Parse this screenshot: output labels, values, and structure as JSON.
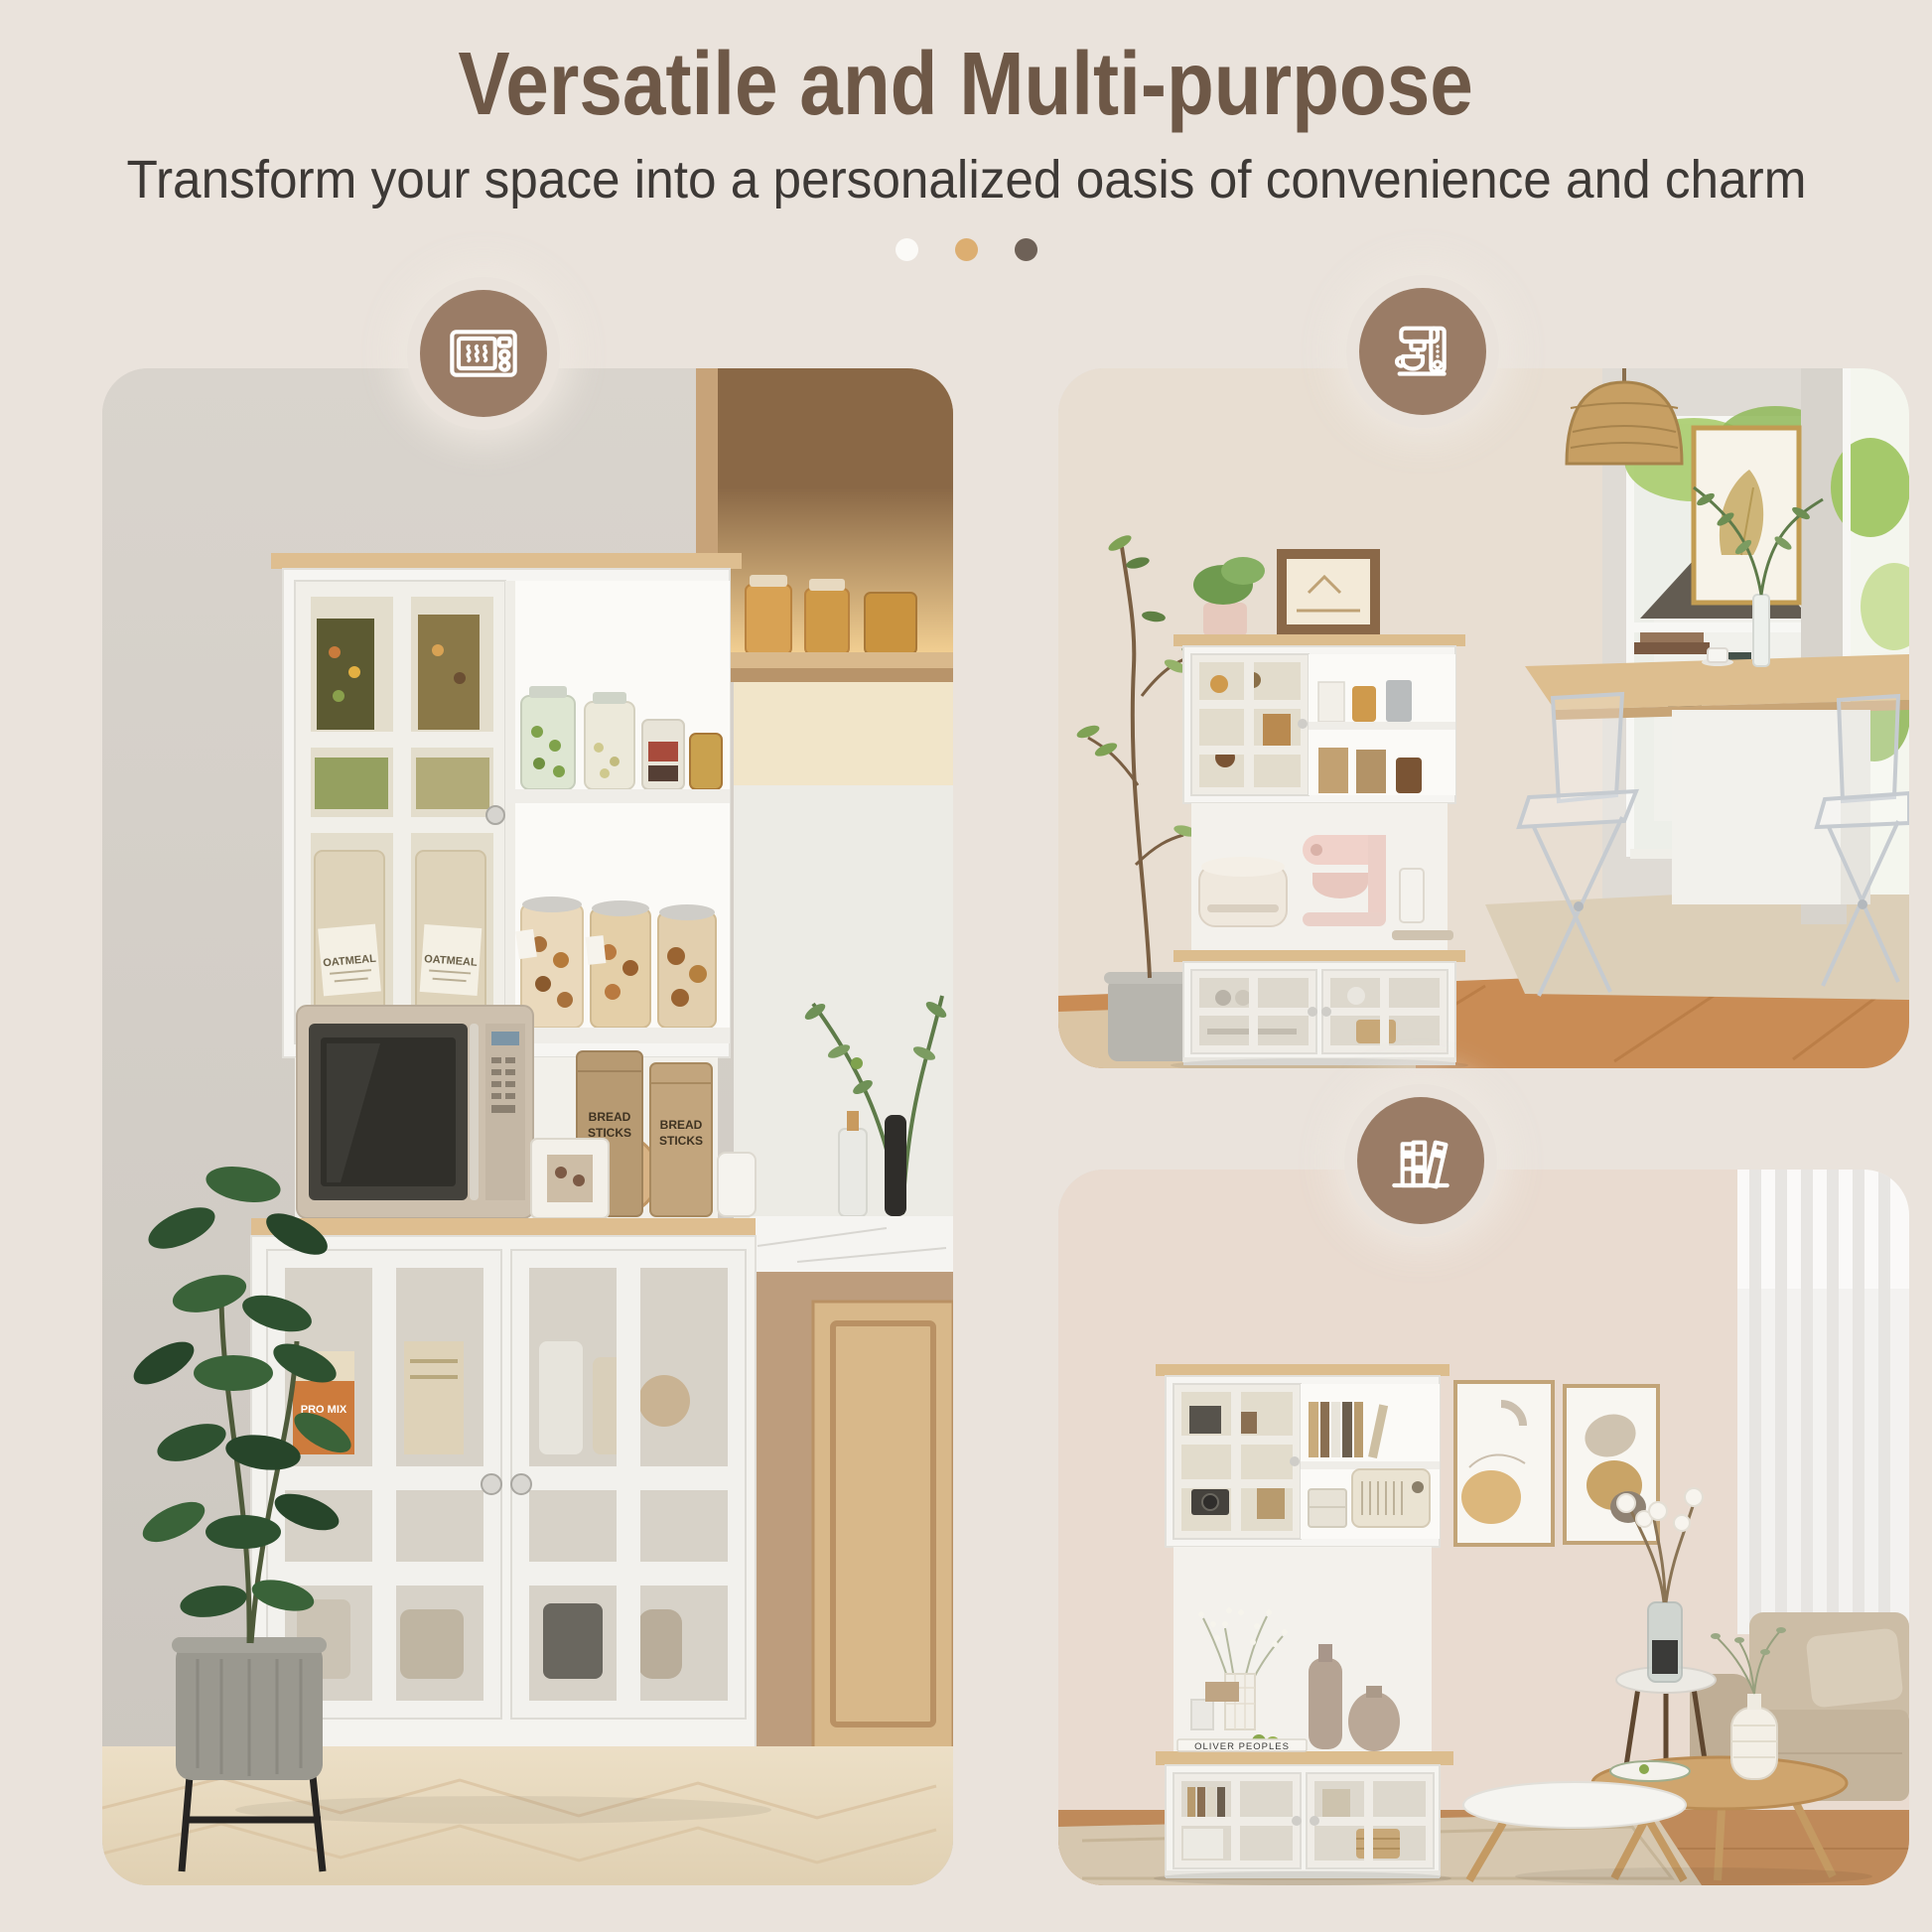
{
  "header": {
    "title": "Versatile and Multi-purpose",
    "subtitle": "Transform your space into a personalized oasis of convenience and charm"
  },
  "carousel_dots": [
    "#fbfaf7",
    "#dcae71",
    "#6e6157"
  ],
  "colors": {
    "background": "#eae3dc",
    "title_brown": "#6e5847",
    "subtitle_gray": "#3d3936",
    "badge_brown": "#9a7c66",
    "badge_icon": "#ffffff",
    "oak_top": "#dcbd8e",
    "cabinet_white": "#f6f5f2"
  },
  "badges": [
    {
      "icon": "microwave-icon"
    },
    {
      "icon": "coffee-machine-icon"
    },
    {
      "icon": "books-icon"
    }
  ],
  "photos": {
    "kitchen_pantry": {
      "description": "Kitchen nook: white buffet hutch with oak top, glass-pane upper cabinet and open shelves full of snack jars, a microwave and bread-stick bags on the counter, two glass doors below, flanked by oak open shelving, a marble-top oak cabinet and a fiddle-leaf fig plant on light herringbone wood flooring",
      "labels": {
        "bread": "BREAD",
        "sticks": "STICKS",
        "oatmeal": "OATMEAL",
        "cereal_box": "PRO MIX"
      }
    },
    "coffee_dining": {
      "description": "Dining room: the white hutch styled as a coffee station with a blush stand mixer and rice cooker, framed art and a plant on top, beside a wood-top dining table with clear acrylic folding chairs, rattan pendant lamp, windows with a white house and greenery outside",
      "labels": {}
    },
    "living_room": {
      "description": "Living room: the white hutch used as a bookcase with books, a vintage radio and vases, beside two abstract framed prints, sheer curtains, a beige fabric armchair, a vase of cotton branches and white-and-wood nesting coffee tables on a patterned rug",
      "labels": {
        "book": "OLIVER PEOPLES"
      }
    }
  }
}
